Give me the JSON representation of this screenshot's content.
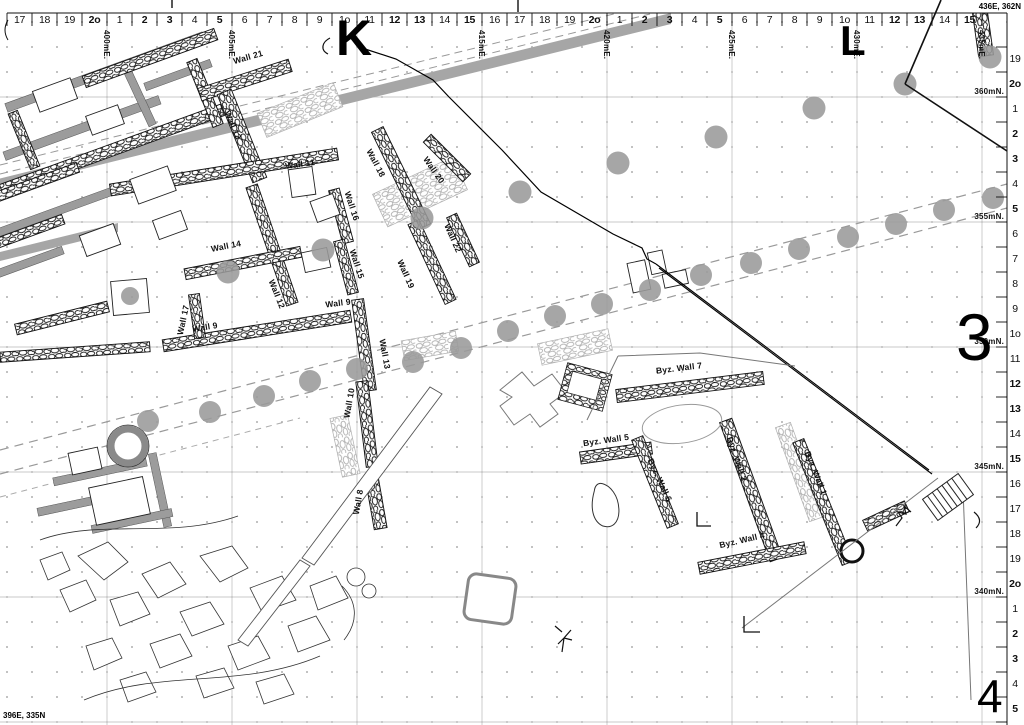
{
  "corners": {
    "ne": "436E, 362N",
    "sw": "396E, 335N"
  },
  "top_ruler": {
    "cells": [
      "17",
      "18",
      "19",
      "2o",
      "1",
      "2",
      "3",
      "4",
      "5",
      "6",
      "7",
      "8",
      "9",
      "1o",
      "11",
      "12",
      "13",
      "14",
      "15",
      "16",
      "17",
      "18",
      "19",
      "2o",
      "1",
      "2",
      "3",
      "4",
      "5",
      "6",
      "7",
      "8",
      "9",
      "1o",
      "11",
      "12",
      "13",
      "14",
      "15"
    ],
    "bold_labels": [
      "2",
      "3",
      "5",
      "12",
      "13",
      "15",
      "2o"
    ],
    "easting_labels": [
      {
        "label": "400mE.",
        "x": 107
      },
      {
        "label": "405mE.",
        "x": 232
      },
      {
        "label": "415mE.",
        "x": 482
      },
      {
        "label": "420mE.",
        "x": 607
      },
      {
        "label": "425mE.",
        "x": 732
      },
      {
        "label": "430mE.",
        "x": 857
      },
      {
        "label": "435mE.",
        "x": 982
      }
    ]
  },
  "right_ruler": {
    "rows": [
      "19",
      "2o",
      "1",
      "2",
      "3",
      "4",
      "5",
      "6",
      "7",
      "8",
      "9",
      "1o",
      "11",
      "12",
      "13",
      "14",
      "15",
      "16",
      "17",
      "18",
      "19",
      "2o",
      "1",
      "2",
      "3",
      "4",
      "5"
    ],
    "northing_labels": [
      {
        "label": "360mN.",
        "y": 92
      },
      {
        "label": "355mN.",
        "y": 217
      },
      {
        "label": "350mN.",
        "y": 342
      },
      {
        "label": "345mN.",
        "y": 467
      },
      {
        "label": "340mN.",
        "y": 592
      }
    ]
  },
  "grid_letters": [
    {
      "label": "K",
      "x": 336,
      "y": 16,
      "size": 50
    },
    {
      "label": "L",
      "x": 840,
      "y": 22,
      "size": 42
    }
  ],
  "zone_numbers": [
    {
      "label": "3",
      "x": 956,
      "y": 308,
      "size": 66
    },
    {
      "label": "4",
      "x": 977,
      "y": 676,
      "size": 46
    }
  ],
  "wall_labels": [
    {
      "text": "Wall 21",
      "x": 248,
      "y": 57,
      "angle": -16
    },
    {
      "text": "Wall 12",
      "x": 233,
      "y": 125,
      "angle": 66
    },
    {
      "text": "Wall 11",
      "x": 300,
      "y": 164,
      "angle": -8
    },
    {
      "text": "Wall 18",
      "x": 376,
      "y": 163,
      "angle": 62
    },
    {
      "text": "Wall 20",
      "x": 434,
      "y": 170,
      "angle": 55
    },
    {
      "text": "Wall 16",
      "x": 352,
      "y": 206,
      "angle": 72
    },
    {
      "text": "Wall 14",
      "x": 226,
      "y": 246,
      "angle": -11
    },
    {
      "text": "Wall 15",
      "x": 357,
      "y": 264,
      "angle": 72
    },
    {
      "text": "Wall 22",
      "x": 453,
      "y": 238,
      "angle": 66
    },
    {
      "text": "Wall 19",
      "x": 406,
      "y": 274,
      "angle": 66
    },
    {
      "text": "Wall 12",
      "x": 277,
      "y": 294,
      "angle": 68
    },
    {
      "text": "Wall 9",
      "x": 338,
      "y": 303,
      "angle": -7
    },
    {
      "text": "Wall 17",
      "x": 183,
      "y": 320,
      "angle": -78
    },
    {
      "text": "Wall 9",
      "x": 205,
      "y": 327,
      "angle": -9
    },
    {
      "text": "Wall 13",
      "x": 385,
      "y": 354,
      "angle": 80
    },
    {
      "text": "Wall 10",
      "x": 349,
      "y": 403,
      "angle": -80
    },
    {
      "text": "Byz. Wall 7",
      "x": 679,
      "y": 368,
      "angle": -7
    },
    {
      "text": "Byz. Wall 5",
      "x": 606,
      "y": 440,
      "angle": -8
    },
    {
      "text": "Byz. Wall 2",
      "x": 737,
      "y": 459,
      "angle": 70
    },
    {
      "text": "Byz. Wall 6",
      "x": 660,
      "y": 480,
      "angle": 65
    },
    {
      "text": "Byz. Wall 1",
      "x": 816,
      "y": 473,
      "angle": 68
    },
    {
      "text": "Wall 8",
      "x": 358,
      "y": 502,
      "angle": -80
    },
    {
      "text": "Byz. Wall 4",
      "x": 742,
      "y": 540,
      "angle": -13
    }
  ],
  "tree_dots": {
    "upper": [
      [
        228,
        272
      ],
      [
        323,
        250
      ],
      [
        422,
        218
      ],
      [
        520,
        192
      ],
      [
        618,
        163
      ],
      [
        716,
        137
      ],
      [
        814,
        108
      ],
      [
        905,
        84
      ],
      [
        990,
        57
      ]
    ],
    "road": [
      [
        148,
        421
      ],
      [
        210,
        412
      ],
      [
        264,
        396
      ],
      [
        310,
        381
      ],
      [
        357,
        369
      ],
      [
        413,
        362
      ],
      [
        461,
        348
      ],
      [
        508,
        331
      ],
      [
        555,
        316
      ],
      [
        602,
        304
      ],
      [
        650,
        290
      ],
      [
        701,
        275
      ],
      [
        751,
        263
      ],
      [
        799,
        249
      ],
      [
        848,
        237
      ],
      [
        896,
        224
      ],
      [
        944,
        210
      ],
      [
        993,
        198
      ]
    ],
    "single": [
      [
        130,
        296,
        9
      ]
    ]
  },
  "colors": {
    "dot": "#9a9a9a",
    "band": "#a6a6a6",
    "grid": "#c9c9c9",
    "dash": "#999999"
  }
}
